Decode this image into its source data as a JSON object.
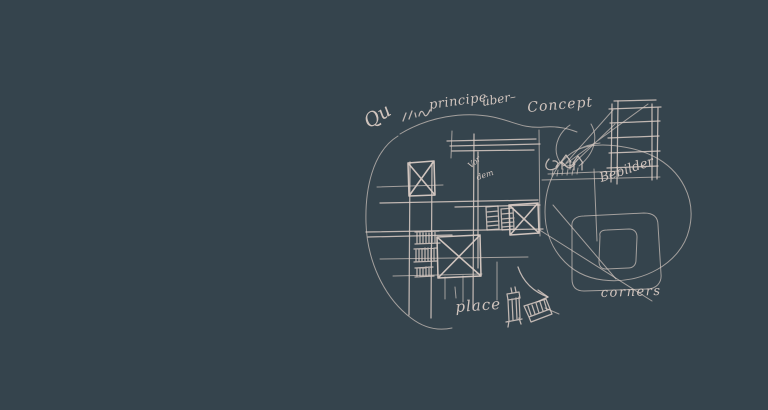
{
  "canvas": {
    "background_color": "#35444d",
    "ink_color": "#d9cbc4"
  },
  "sketch": {
    "annotations": {
      "qu": "Qu",
      "principe": "principe",
      "uber": "über–",
      "concept": "Concept",
      "vor": "Vor",
      "dem": "dem",
      "bebilder": "Bebilder",
      "place": "place",
      "corners": "corners"
    }
  }
}
